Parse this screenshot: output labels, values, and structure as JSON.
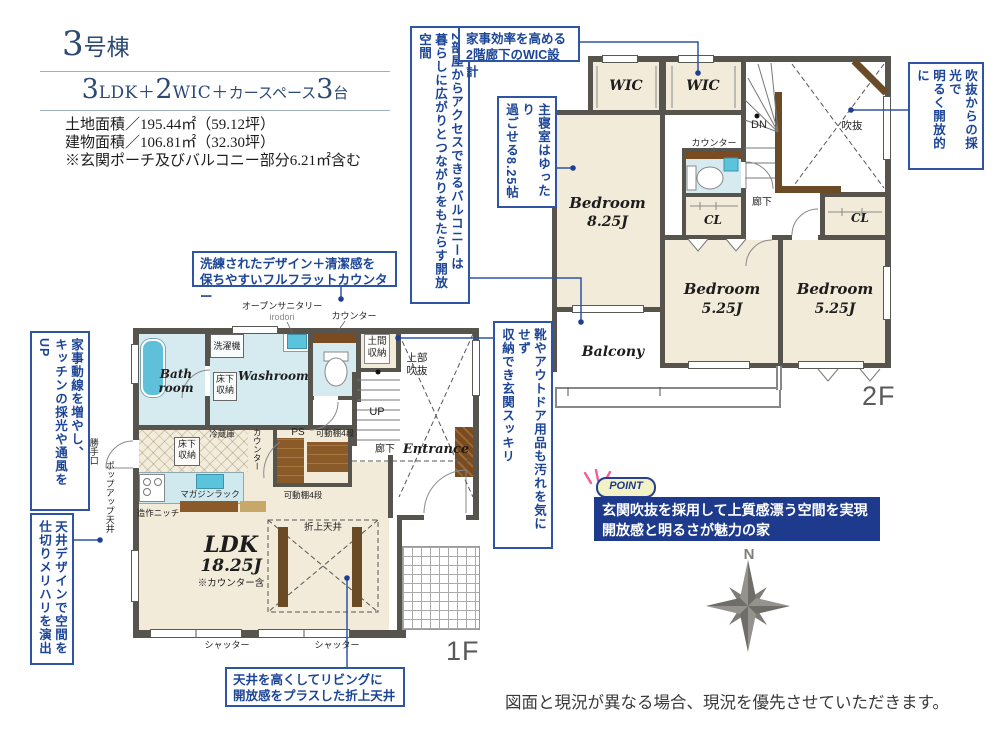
{
  "header": {
    "building_no": {
      "num": "3",
      "suffix": "号棟"
    },
    "plan": [
      "3",
      "LDK＋",
      "2",
      "WIC＋",
      "カースペース",
      "3",
      "台"
    ],
    "land_area": "土地面積／195.44㎡（59.12坪）",
    "building_area": "建物面積／106.81㎡（32.30坪）",
    "area_note": "※玄関ポーチ及びバルコニー部分6.21㎡含む"
  },
  "callouts": {
    "balcony_access": {
      "line1": "2部屋からアクセスできるバルコニーは",
      "line2": "暮らしに広がりとつながりをもたらす開放空間"
    },
    "wic_design": {
      "line1": "家事効率を高める",
      "line2": "2階廊下のWIC設計"
    },
    "void_light": {
      "line1": "吹抜からの採光で",
      "line2": "明るく開放的に"
    },
    "master_room": {
      "line1": "主寝室はゆったり",
      "line2": "過ごせる8.25帖"
    },
    "genkan_storage": {
      "line1": "靴やアウトドア用品も汚れを気にせず",
      "line2": "収納でき玄関スッキリ"
    },
    "flat_counter": {
      "line1": "洗練されたデザイン＋清潔感を",
      "line2": "保ちやすいフルフラットカウンター"
    },
    "kaji_dosen": {
      "line1": "家事動線を増やし、",
      "line2": "キッチンの採光や通風をUP"
    },
    "ceiling_design": {
      "line1": "天井デザインで空間を",
      "line2": "仕切りメリハリを演出"
    },
    "oriage_ceiling": {
      "line1": "天井を高くしてリビングに",
      "line2": "開放感をプラスした折上天井"
    }
  },
  "point_box": {
    "badge": "POINT",
    "line1": "玄関吹抜を採用して上質感漂う空間を実現",
    "line2": "開放感と明るさが魅力の家"
  },
  "floor2": {
    "floor_label": "2F",
    "wic1": "WIC",
    "wic2": "WIC",
    "dn": "DN",
    "counter": "カウンター",
    "void_label": "吹抜",
    "corridor": "廊下",
    "cl1": "CL",
    "cl2": "CL",
    "bedroom_main": {
      "name": "Bedroom",
      "size": "8.25J"
    },
    "bedroom2": {
      "name": "Bedroom",
      "size": "5.25J"
    },
    "bedroom3": {
      "name": "Bedroom",
      "size": "5.25J"
    },
    "balcony": "Balcony"
  },
  "floor1": {
    "floor_label": "1F",
    "bath": "Bath room",
    "washer": "洗濯機",
    "underfloor1": "床下収納",
    "washroom": "Washroom",
    "open_sanitary": "オープンサニタリー",
    "open_sanitary_sub": "irodori",
    "counter1": "カウンター",
    "doma": "土間収納",
    "upper_void": "上部吹抜",
    "up": "UP",
    "corridor": "廊下",
    "entrance": "Entrance",
    "fridge": "冷蔵庫",
    "counter2": "カウンター",
    "ps": "PS",
    "shelf1": "可動棚4段",
    "shelf2": "可動棚4段",
    "underfloor2": "床下収納",
    "magazine_rack": "マガジンラック",
    "niche": "造作ニッチ",
    "popup_ceiling": "ポップアップ天井",
    "back_door": "勝手口",
    "ldk": {
      "name": "LDK",
      "size": "18.25J",
      "note": "※カウンター含"
    },
    "oriage": "折上天井",
    "shutter1": "シャッター",
    "shutter2": "シャッター"
  },
  "compass": {
    "north": "N"
  },
  "disclaimer": "図面と現況が異なる場合、現況を優先させていただきます。"
}
